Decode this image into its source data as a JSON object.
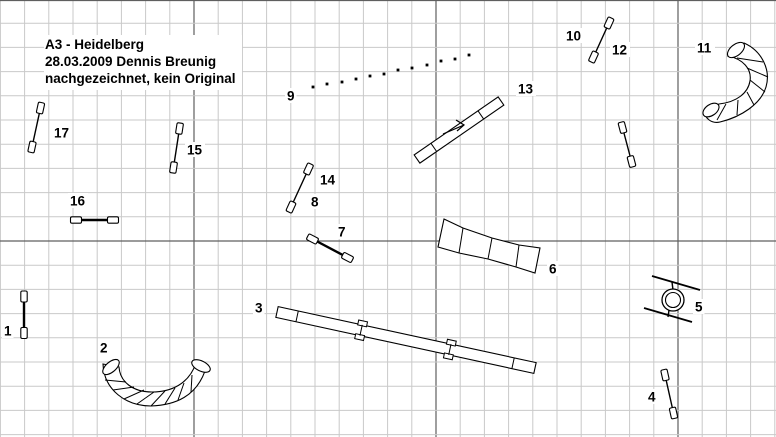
{
  "meta": {
    "description": "Dog agility course plan (hand-redrawn)",
    "title_lines": [
      "A3 - Heidelberg",
      "28.03.2009 Dennis Breunig",
      "nachgezeichnet, kein Original"
    ]
  },
  "colors": {
    "background": "#ffffff",
    "grid_minor": "#c9c9c9",
    "grid_major": "#5f5f5f",
    "ink": "#000000",
    "fill": "#ffffff"
  },
  "grid": {
    "width": 776,
    "height": 437,
    "spacing": 24.2,
    "x0": 0.4,
    "y0": -1,
    "v_major_offset": 8,
    "h_major_offset": 0,
    "major_every": 10
  },
  "obstacles": [
    {
      "id": "jump-1",
      "type": "jump",
      "labels": [
        {
          "text": "1",
          "x": 4,
          "y": 324
        }
      ],
      "a": [
        24,
        296.5
      ],
      "b": [
        24,
        333
      ],
      "bar": 2.4
    },
    {
      "id": "tunnel-2",
      "type": "tunnel",
      "labels": [
        {
          "text": "2",
          "x": 100,
          "y": 341
        }
      ],
      "band": "M103,364 C104,390 126,406 151,406 C176,405 196,396 205,371 L196,363 C189,384 171,392 152,392 C133,392 120,382 119,367 Z",
      "hatches": [
        [
          126,
          382,
          105,
          380
        ],
        [
          134,
          387,
          113,
          390
        ],
        [
          144,
          390,
          124,
          399
        ],
        [
          154,
          392,
          137,
          404
        ],
        [
          165,
          391,
          151,
          406
        ],
        [
          175,
          388,
          165,
          404
        ],
        [
          184,
          383,
          178,
          400
        ],
        [
          192,
          375,
          191,
          392
        ]
      ],
      "ends": [
        {
          "cx": 111,
          "cy": 367,
          "rx": 10,
          "ry": 5,
          "rot": -41
        },
        {
          "cx": 201,
          "cy": 366,
          "rx": 10,
          "ry": 5,
          "rot": 26
        }
      ]
    },
    {
      "id": "dogwalk-3",
      "type": "plank",
      "labels": [
        {
          "text": "3",
          "x": 255,
          "y": 301
        }
      ],
      "a": [
        277,
        312
      ],
      "b": [
        535,
        368
      ],
      "w": 11,
      "dividers": [
        0.078,
        0.915
      ],
      "supports": [
        0.326,
        0.67
      ]
    },
    {
      "id": "jump-4",
      "type": "jump",
      "labels": [
        {
          "text": "4",
          "x": 648,
          "y": 390
        }
      ],
      "a": [
        665,
        375
      ],
      "b": [
        673.5,
        413
      ],
      "bar": 1.4
    },
    {
      "id": "tire-5",
      "type": "tire",
      "labels": [
        {
          "text": "5",
          "x": 695,
          "y": 300
        }
      ],
      "center": [
        673,
        300
      ],
      "r_outer": 11,
      "r_inner": 7.5,
      "bars": [
        [
          652,
          276,
          700,
          290
        ],
        [
          644,
          308,
          692,
          322
        ]
      ],
      "connectors": [
        [
          672,
          282,
          673,
          290
        ],
        [
          669,
          310,
          668,
          317
        ]
      ]
    },
    {
      "id": "chute-6",
      "type": "chute",
      "labels": [
        {
          "text": "6",
          "x": 549,
          "y": 262
        }
      ],
      "top": [
        [
          444,
          219
        ],
        [
          463,
          228
        ],
        [
          492,
          238
        ],
        [
          519,
          245
        ],
        [
          540,
          248
        ]
      ],
      "bottom": [
        [
          438,
          247
        ],
        [
          459,
          253
        ],
        [
          488,
          259
        ],
        [
          516,
          267
        ],
        [
          535,
          273
        ]
      ]
    },
    {
      "id": "jump-7",
      "type": "jump",
      "labels": [
        {
          "text": "7",
          "x": 338,
          "y": 225
        }
      ],
      "a": [
        312.5,
        239
      ],
      "b": [
        347.5,
        257.5
      ],
      "bar": 2.4
    },
    {
      "id": "jump-8-14",
      "type": "jump",
      "labels": [
        {
          "text": "8",
          "x": 311,
          "y": 195
        },
        {
          "text": "14",
          "x": 320,
          "y": 173
        }
      ],
      "a": [
        291,
        207
      ],
      "b": [
        308.5,
        169
      ],
      "bar": 1.4
    },
    {
      "id": "weave-9",
      "type": "weave",
      "labels": [
        {
          "text": "9",
          "x": 287,
          "y": 89
        }
      ],
      "dots": [
        [
          313,
          87
        ],
        [
          327,
          84
        ],
        [
          342,
          82
        ],
        [
          356,
          79
        ],
        [
          370,
          76
        ],
        [
          384,
          74
        ],
        [
          398,
          70
        ],
        [
          412,
          68
        ],
        [
          427,
          65
        ],
        [
          441,
          61
        ],
        [
          455,
          59
        ],
        [
          469,
          55
        ]
      ]
    },
    {
      "id": "jump-10-12",
      "type": "jump",
      "labels": [
        {
          "text": "10",
          "x": 566,
          "y": 29
        },
        {
          "text": "12",
          "x": 612,
          "y": 43
        }
      ],
      "a": [
        593.5,
        57
      ],
      "b": [
        609,
        23
      ],
      "bar": 1.4
    },
    {
      "id": "tunnel-11",
      "type": "tunnel",
      "labels": [
        {
          "text": "11",
          "x": 697,
          "y": 41
        }
      ],
      "band": "M744,43 C762,51 771,70 766,87 C761,104 741,117 720,122 C711,124 705,118 704,111 L719,104 C737,102 748,93 750,81 C752,69 743,59 728,56 Z",
      "hatches": [
        [
          737,
          58,
          763,
          62
        ],
        [
          747,
          68,
          768,
          77
        ],
        [
          750,
          80,
          765,
          92
        ],
        [
          747,
          92,
          754,
          105
        ],
        [
          738,
          100,
          737,
          115
        ],
        [
          726,
          104,
          717,
          120
        ]
      ],
      "ends": [
        {
          "cx": 736,
          "cy": 50,
          "rx": 10,
          "ry": 5.5,
          "rot": -39
        },
        {
          "cx": 711,
          "cy": 110,
          "rx": 9,
          "ry": 5.5,
          "rot": -35
        }
      ]
    },
    {
      "id": "seesaw-13",
      "type": "plank",
      "labels": [
        {
          "text": "13",
          "x": 518,
          "y": 82
        }
      ],
      "a": [
        417,
        159
      ],
      "b": [
        501,
        101
      ],
      "w": 10,
      "dividers": [
        0.2,
        0.76
      ],
      "supports": [],
      "arrow": {
        "shaft": [
          443,
          134,
          464,
          125
        ],
        "head": [
          [
            456,
            120
          ],
          [
            464,
            125
          ],
          [
            457,
            131
          ]
        ]
      }
    },
    {
      "id": "jump-15",
      "type": "jump",
      "labels": [
        {
          "text": "15",
          "x": 187,
          "y": 143
        }
      ],
      "a": [
        173.5,
        167.5
      ],
      "b": [
        179.5,
        128.5
      ],
      "bar": 1.4
    },
    {
      "id": "jump-16",
      "type": "jump",
      "labels": [
        {
          "text": "16",
          "x": 70,
          "y": 194
        }
      ],
      "a": [
        76,
        220
      ],
      "b": [
        113,
        220
      ],
      "bar": 2.4
    },
    {
      "id": "jump-17",
      "type": "jump",
      "labels": [
        {
          "text": "17",
          "x": 54,
          "y": 126
        }
      ],
      "a": [
        32,
        147
      ],
      "b": [
        40.5,
        108
      ],
      "bar": 1.4
    },
    {
      "id": "jump-extra",
      "type": "jump",
      "labels": [],
      "a": [
        622.5,
        127.5
      ],
      "b": [
        631.5,
        161.5
      ],
      "bar": 1.4
    }
  ]
}
